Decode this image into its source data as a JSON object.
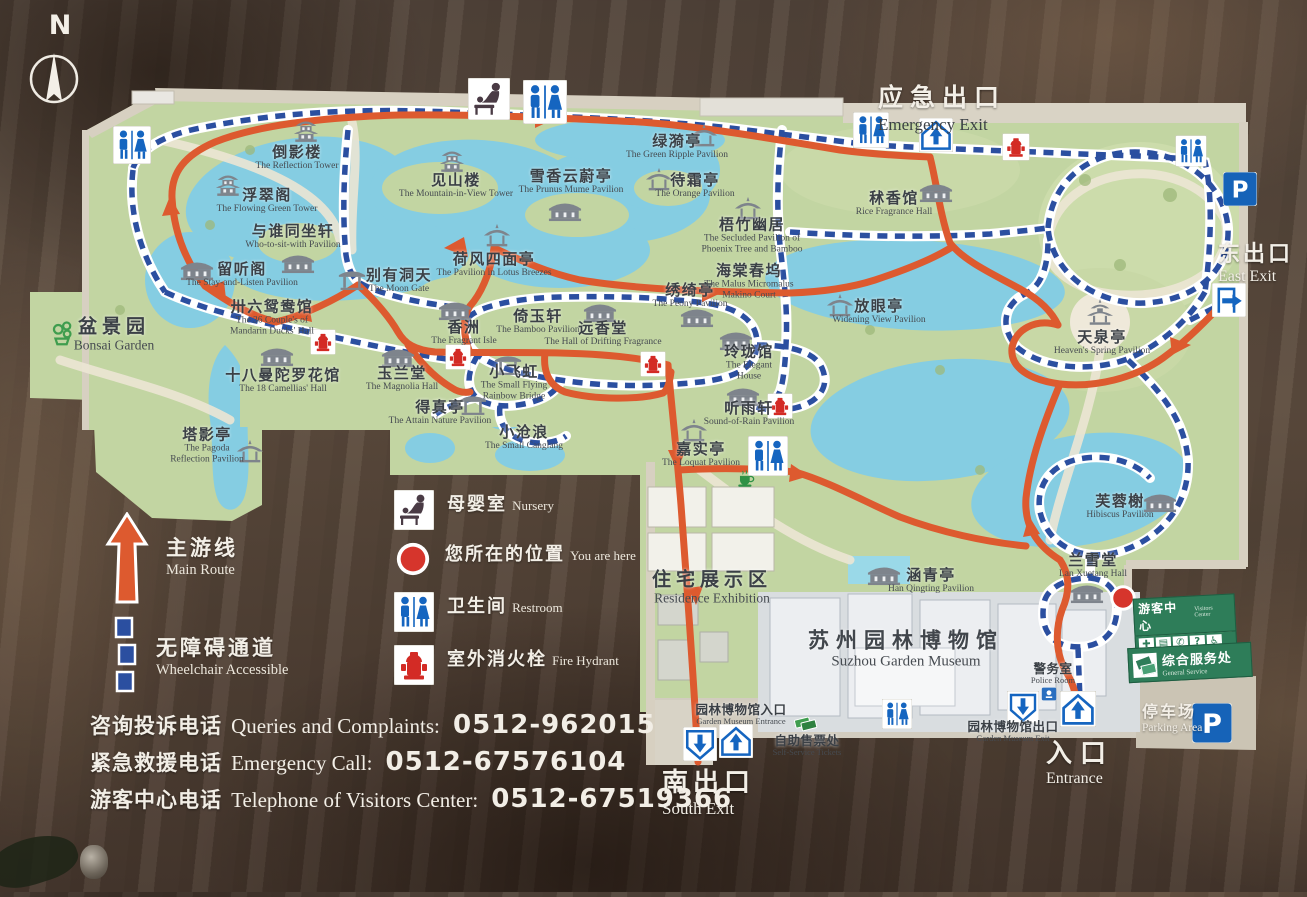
{
  "compass": {
    "label": "N"
  },
  "exits": {
    "emergency_zh": "应急出口",
    "emergency_en": "Emergency Exit",
    "east_zh": "东出口",
    "east_en": "East Exit",
    "south_zh": "南出口",
    "south_en": "South Exit",
    "entrance_zh": "入口",
    "entrance_en": "Entrance",
    "parking_zh": "停车场",
    "parking_en": "Parking Area"
  },
  "legend": {
    "main_route": {
      "zh": "主游线",
      "en": "Main Route"
    },
    "wheelchair": {
      "zh": "无障碍通道",
      "en": "Wheelchair Accessible"
    },
    "nursery": {
      "zh": "母婴室",
      "en": "Nursery"
    },
    "you_are_here": {
      "zh": "您所在的位置",
      "en": "You are here"
    },
    "restroom": {
      "zh": "卫生间",
      "en": "Restroom"
    },
    "fire_hydrant": {
      "zh": "室外消火栓",
      "en": "Fire Hydrant"
    }
  },
  "phones": [
    {
      "zh": "咨询投诉电话",
      "en": "Queries and Complaints:",
      "num": "0512-962015"
    },
    {
      "zh": "紧急救援电话",
      "en": "Emergency Call:",
      "num": "0512-67576104"
    },
    {
      "zh": "游客中心电话",
      "en": "Telephone of Visitors Center:",
      "num": "0512-67519366"
    }
  ],
  "visitor_center": {
    "title_zh": "游客中心",
    "title_en": "Visitors Center",
    "service_zh": "综合服务处",
    "service_en": "General Service",
    "icons": [
      "first-aid",
      "ticket-card",
      "telephone",
      "information",
      "wheelchair"
    ]
  },
  "colors": {
    "route_main": "#dd5a2f",
    "route_accessible": "#2b4fa0",
    "water": "#85cde2",
    "lawn": "#c2d5a2",
    "wall": "#d7d0c1",
    "board_wood": "#52443a",
    "label_text": "#3b4046",
    "exit_text": "#f3efe7"
  },
  "map": {
    "pois": [
      {
        "zh": "倒影楼",
        "en": "The Reflection Tower",
        "x": 297,
        "y": 158,
        "icon": {
          "t": "tower",
          "x": 306,
          "y": 132
        }
      },
      {
        "zh": "浮翠阁",
        "en": "The Flowing Green Tower",
        "x": 267,
        "y": 201,
        "icon": {
          "t": "tower",
          "x": 228,
          "y": 186
        }
      },
      {
        "zh": "与谁同坐轩",
        "en": "Who-to-sit-with Pavilion",
        "x": 293,
        "y": 237,
        "icon": {
          "t": "hall",
          "x": 298,
          "y": 264
        }
      },
      {
        "zh": "留听阁",
        "en": "The Stay-and-Listen Pavilion",
        "x": 242,
        "y": 275,
        "icon": {
          "t": "hall",
          "x": 197,
          "y": 271
        }
      },
      {
        "zh": "卅六鸳鸯馆",
        "en": "The 36 Couple's of",
        "en2": "Mandarin Ducks' Hall",
        "x": 272,
        "y": 318,
        "icon": {
          "t": "hall",
          "x": 277,
          "y": 357
        }
      },
      {
        "zh": "十八曼陀罗花馆",
        "en": "The 18 Camellias' Hall",
        "x": 283,
        "y": 381
      },
      {
        "zh": "玉兰堂",
        "en": "The Magnolia Hall",
        "x": 402,
        "y": 379,
        "icon": {
          "t": "hall",
          "x": 398,
          "y": 358
        }
      },
      {
        "zh": "塔影亭",
        "en": "The Pagoda",
        "en2": "Reflection Pavilion",
        "x": 207,
        "y": 446,
        "icon": {
          "t": "pav",
          "x": 250,
          "y": 452
        }
      },
      {
        "zh": "别有洞天",
        "en": "The Moon Gate",
        "x": 399,
        "y": 281,
        "icon": {
          "t": "gate",
          "x": 352,
          "y": 279
        }
      },
      {
        "zh": "见山楼",
        "en": "The Mountain-in-View Tower",
        "x": 456,
        "y": 186,
        "icon": {
          "t": "tower",
          "x": 452,
          "y": 162
        }
      },
      {
        "zh": "荷风四面亭",
        "en": "The Pavilion in Lotus Breezes",
        "x": 494,
        "y": 265,
        "icon": {
          "t": "pav",
          "x": 497,
          "y": 236
        }
      },
      {
        "zh": "香洲",
        "en": "The Fragrant Isle",
        "x": 464,
        "y": 333,
        "icon": {
          "t": "hall",
          "x": 455,
          "y": 311
        }
      },
      {
        "zh": "倚玉轩",
        "en": "The Bamboo Pavilion",
        "x": 538,
        "y": 322
      },
      {
        "zh": "远香堂",
        "en": "The Hall of Drifting Fragrance",
        "x": 603,
        "y": 334,
        "icon": {
          "t": "hall",
          "x": 600,
          "y": 313
        }
      },
      {
        "zh": "小飞虹",
        "en": "The Small Flying",
        "en2": "Rainbow Bridge",
        "x": 514,
        "y": 383,
        "icon": {
          "t": "gate",
          "x": 508,
          "y": 364
        }
      },
      {
        "zh": "得真亭",
        "en": "The Attain Nature Pavilion",
        "x": 440,
        "y": 413,
        "icon": {
          "t": "gate",
          "x": 473,
          "y": 404
        }
      },
      {
        "zh": "小沧浪",
        "en": "The Small Canglang",
        "x": 524,
        "y": 438
      },
      {
        "zh": "雪香云蔚亭",
        "en": "The Prunus Mume Pavilion",
        "x": 571,
        "y": 182,
        "icon": {
          "t": "hall",
          "x": 565,
          "y": 212
        }
      },
      {
        "zh": "绿漪亭",
        "en": "The Green Ripple Pavilion",
        "x": 677,
        "y": 147,
        "icon": {
          "t": "pav",
          "x": 704,
          "y": 136
        }
      },
      {
        "zh": "待霜亭",
        "en": "The Orange Pavilion",
        "x": 695,
        "y": 186,
        "icon": {
          "t": "pav",
          "x": 659,
          "y": 180
        }
      },
      {
        "zh": "梧竹幽居",
        "en": "The Secluded Pavilion of",
        "en2": "Phoenix Tree and Bamboo",
        "x": 752,
        "y": 236,
        "icon": {
          "t": "pav",
          "x": 748,
          "y": 209
        }
      },
      {
        "zh": "绣绮亭",
        "en": "The Peony Pavilion",
        "x": 690,
        "y": 296,
        "icon": {
          "t": "hall",
          "x": 697,
          "y": 318
        }
      },
      {
        "zh": "海棠春坞",
        "en": "The Malus Micromalus",
        "en2": "Makino Court",
        "x": 749,
        "y": 282
      },
      {
        "zh": "玲珑馆",
        "en": "The Elegant",
        "en2": "House",
        "x": 749,
        "y": 363,
        "icon": {
          "t": "hall",
          "x": 736,
          "y": 341
        }
      },
      {
        "zh": "听雨轩",
        "en": "Sound-of-Rain Pavilion",
        "x": 749,
        "y": 414,
        "icon": {
          "t": "hall",
          "x": 743,
          "y": 397
        }
      },
      {
        "zh": "嘉实亭",
        "en": "The Loquat Pavilion",
        "x": 701,
        "y": 455,
        "icon": {
          "t": "pav",
          "x": 694,
          "y": 431
        }
      },
      {
        "zh": "秫香馆",
        "en": "Rice Fragrance Hall",
        "x": 894,
        "y": 204,
        "icon": {
          "t": "hall",
          "x": 936,
          "y": 193
        }
      },
      {
        "zh": "放眼亭",
        "en": "Widening View Pavilion",
        "x": 879,
        "y": 312,
        "icon": {
          "t": "pav",
          "x": 840,
          "y": 306
        }
      },
      {
        "zh": "天泉亭",
        "en": "Heaven's Spring Pavilion",
        "x": 1102,
        "y": 343,
        "icon": {
          "t": "pav2",
          "x": 1100,
          "y": 313
        }
      },
      {
        "zh": "芙蓉榭",
        "en": "Hibiscus Pavilion",
        "x": 1120,
        "y": 507,
        "icon": {
          "t": "hall",
          "x": 1160,
          "y": 503
        }
      },
      {
        "zh": "兰雪堂",
        "en": "Lan Xuetang Hall",
        "x": 1093,
        "y": 566,
        "icon": {
          "t": "hall",
          "x": 1087,
          "y": 594
        }
      },
      {
        "zh": "涵青亭",
        "en": "Han Qingting Pavilion",
        "x": 931,
        "y": 581,
        "icon": {
          "t": "hall",
          "x": 884,
          "y": 576
        }
      },
      {
        "zh": "盆景园",
        "en": "Bonsai Garden",
        "x": 114,
        "y": 335,
        "cls": "area",
        "icon": {
          "t": "bonsai",
          "x": 62,
          "y": 333
        }
      },
      {
        "zh": "住宅展示区",
        "en": "Residence Exhibition",
        "x": 712,
        "y": 588,
        "cls": "area"
      },
      {
        "zh": "苏州园林博物馆",
        "en": "Suzhou Garden Museum",
        "x": 906,
        "y": 650,
        "cls": "area2"
      },
      {
        "zh": "园林博物馆入口",
        "en": "Garden Museum Entrance",
        "x": 741,
        "y": 715,
        "cls": "small"
      },
      {
        "zh": "自助售票处",
        "en": "Self-Service Tickets",
        "x": 807,
        "y": 746,
        "cls": "small"
      },
      {
        "zh": "园林博物馆出口",
        "en": "Garden Museum Exit",
        "x": 1013,
        "y": 732,
        "cls": "small"
      },
      {
        "zh": "警务室",
        "en": "Police Room",
        "x": 1053,
        "y": 674,
        "cls": "small"
      }
    ],
    "amenities": [
      {
        "t": "wc",
        "x": 132,
        "y": 145,
        "s": 38
      },
      {
        "t": "nursery",
        "x": 489,
        "y": 99,
        "s": 42
      },
      {
        "t": "wc",
        "x": 545,
        "y": 102,
        "s": 44
      },
      {
        "t": "wc",
        "x": 871,
        "y": 130,
        "s": 36
      },
      {
        "t": "exitup",
        "x": 936,
        "y": 135,
        "s": 34
      },
      {
        "t": "hydrant",
        "x": 1016,
        "y": 147,
        "s": 27
      },
      {
        "t": "wc",
        "x": 1191,
        "y": 151,
        "s": 31
      },
      {
        "t": "parking",
        "x": 1240,
        "y": 189,
        "s": 34
      },
      {
        "t": "exitright",
        "x": 1229,
        "y": 300,
        "s": 34
      },
      {
        "t": "hydrant",
        "x": 323,
        "y": 342,
        "s": 25
      },
      {
        "t": "hydrant",
        "x": 458,
        "y": 357,
        "s": 25
      },
      {
        "t": "hydrant",
        "x": 653,
        "y": 364,
        "s": 25
      },
      {
        "t": "hydrant",
        "x": 780,
        "y": 406,
        "s": 25
      },
      {
        "t": "wc",
        "x": 768,
        "y": 456,
        "s": 40
      },
      {
        "t": "teacup",
        "x": 746,
        "y": 479,
        "s": 23
      },
      {
        "t": "wc",
        "x": 897,
        "y": 714,
        "s": 30
      },
      {
        "t": "exitdown",
        "x": 700,
        "y": 744,
        "s": 34
      },
      {
        "t": "exitup",
        "x": 736,
        "y": 741,
        "s": 34
      },
      {
        "t": "tickets",
        "x": 806,
        "y": 724,
        "s": 28
      },
      {
        "t": "exitdown",
        "x": 1023,
        "y": 707,
        "s": 32
      },
      {
        "t": "exitup",
        "x": 1078,
        "y": 709,
        "s": 36
      },
      {
        "t": "badge",
        "x": 1049,
        "y": 694,
        "s": 16
      },
      {
        "t": "youarehere",
        "x": 1123,
        "y": 598,
        "s": 30
      },
      {
        "t": "parking",
        "x": 1212,
        "y": 723,
        "s": 40
      }
    ]
  }
}
